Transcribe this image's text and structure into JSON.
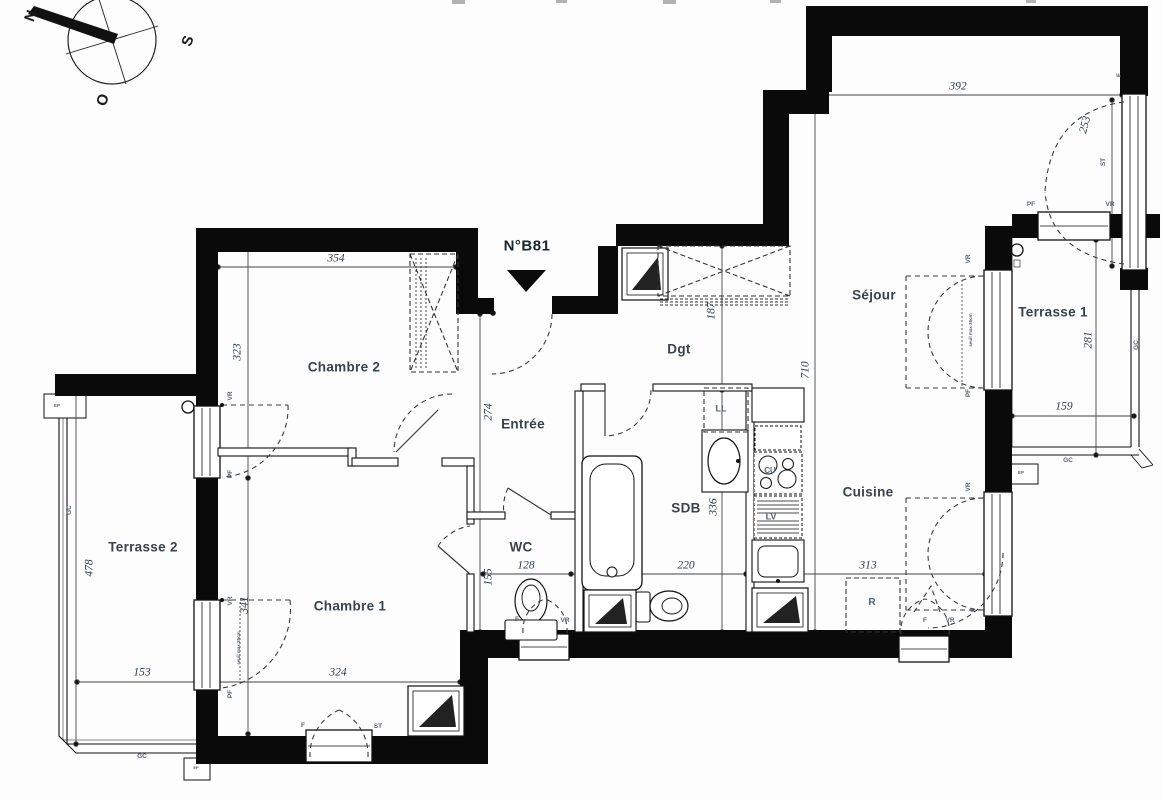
{
  "meta": {
    "plan_number": "N°B81"
  },
  "compass": {
    "points": [
      {
        "letter": "N",
        "x": 31,
        "y": 16,
        "rot": -70
      },
      {
        "letter": "S",
        "x": 188,
        "y": 41,
        "rot": -70
      },
      {
        "letter": "O",
        "x": 103,
        "y": 100,
        "rot": -70
      }
    ]
  },
  "rooms": [
    {
      "id": "chambre-2",
      "name": "Chambre 2",
      "x": 344,
      "y": 367
    },
    {
      "id": "chambre-1",
      "name": "Chambre 1",
      "x": 350,
      "y": 606
    },
    {
      "id": "entree",
      "name": "Entrée",
      "x": 523,
      "y": 424
    },
    {
      "id": "wc",
      "name": "WC",
      "x": 521,
      "y": 547
    },
    {
      "id": "sdb",
      "name": "SDB",
      "x": 686,
      "y": 508
    },
    {
      "id": "dgt",
      "name": "Dgt",
      "x": 679,
      "y": 349
    },
    {
      "id": "sejour",
      "name": "Séjour",
      "x": 874,
      "y": 295
    },
    {
      "id": "cuisine",
      "name": "Cuisine",
      "x": 868,
      "y": 492
    },
    {
      "id": "terrasse-1",
      "name": "Terrasse 1",
      "x": 1053,
      "y": 312
    },
    {
      "id": "terrasse-2",
      "name": "Terrasse 2",
      "x": 143,
      "y": 547
    }
  ],
  "dimensions": [
    {
      "value": "354",
      "x": 336,
      "y": 259,
      "rot": 0
    },
    {
      "value": "323",
      "x": 238,
      "y": 352,
      "rot": -90
    },
    {
      "value": "341",
      "x": 245,
      "y": 605,
      "rot": -90
    },
    {
      "value": "324",
      "x": 338,
      "y": 673,
      "rot": 0
    },
    {
      "value": "274",
      "x": 489,
      "y": 412,
      "rot": -90
    },
    {
      "value": "155",
      "x": 489,
      "y": 577,
      "rot": -90
    },
    {
      "value": "128",
      "x": 526,
      "y": 566,
      "rot": 0
    },
    {
      "value": "220",
      "x": 686,
      "y": 566,
      "rot": 0
    },
    {
      "value": "313",
      "x": 868,
      "y": 566,
      "rot": 0
    },
    {
      "value": "187",
      "x": 712,
      "y": 311,
      "rot": -90
    },
    {
      "value": "336",
      "x": 714,
      "y": 507,
      "rot": -90
    },
    {
      "value": "710",
      "x": 806,
      "y": 370,
      "rot": -90
    },
    {
      "value": "392",
      "x": 958,
      "y": 87,
      "rot": 0
    },
    {
      "value": "253",
      "x": 1086,
      "y": 125,
      "rot": -75
    },
    {
      "value": "281",
      "x": 1089,
      "y": 340,
      "rot": -90
    },
    {
      "value": "159",
      "x": 1064,
      "y": 407,
      "rot": 0
    },
    {
      "value": "478",
      "x": 90,
      "y": 568,
      "rot": -90
    },
    {
      "value": "153",
      "x": 142,
      "y": 673,
      "rot": 0
    }
  ],
  "labels": [
    {
      "text": "VR",
      "x": 231,
      "y": 396,
      "rot": -90
    },
    {
      "text": "PF",
      "x": 231,
      "y": 474,
      "rot": -90
    },
    {
      "text": "VR",
      "x": 231,
      "y": 601,
      "rot": -90
    },
    {
      "text": "PF",
      "x": 231,
      "y": 694,
      "rot": -90
    },
    {
      "text": "seuil max 35cm",
      "x": 239,
      "y": 648,
      "rot": -90,
      "size": 4.5
    },
    {
      "text": "F",
      "x": 517,
      "y": 620,
      "rot": 0
    },
    {
      "text": "VR",
      "x": 565,
      "y": 621,
      "rot": 0
    },
    {
      "text": "F",
      "x": 303,
      "y": 726,
      "rot": 0
    },
    {
      "text": "ST",
      "x": 378,
      "y": 727,
      "rot": 0
    },
    {
      "text": "F",
      "x": 925,
      "y": 621,
      "rot": 0
    },
    {
      "text": "VR",
      "x": 950,
      "y": 621,
      "rot": 0
    },
    {
      "text": "VR",
      "x": 969,
      "y": 259,
      "rot": -90
    },
    {
      "text": "PF",
      "x": 969,
      "y": 393,
      "rot": -90
    },
    {
      "text": "seuil max 35cm",
      "x": 971,
      "y": 330,
      "rot": -90,
      "size": 4.5
    },
    {
      "text": "VR",
      "x": 969,
      "y": 487,
      "rot": -90
    },
    {
      "text": "F",
      "x": 974,
      "y": 610,
      "rot": -90
    },
    {
      "text": "PF",
      "x": 1031,
      "y": 205,
      "rot": 0
    },
    {
      "text": "VR",
      "x": 1110,
      "y": 205,
      "rot": 0
    },
    {
      "text": "F",
      "x": 1120,
      "y": 75,
      "rot": -90
    },
    {
      "text": "ST",
      "x": 1104,
      "y": 162,
      "rot": -90
    },
    {
      "text": "GC",
      "x": 70,
      "y": 510,
      "rot": -90
    },
    {
      "text": "GC",
      "x": 142,
      "y": 757,
      "rot": 0
    },
    {
      "text": "GC",
      "x": 1137,
      "y": 345,
      "rot": -90
    },
    {
      "text": "GC",
      "x": 1068,
      "y": 461,
      "rot": 0
    },
    {
      "text": "EP",
      "x": 57,
      "y": 406,
      "rot": 0,
      "size": 4.5
    },
    {
      "text": "EP",
      "x": 1021,
      "y": 473,
      "rot": 0,
      "size": 4.5
    },
    {
      "text": "EP",
      "x": 196,
      "y": 768,
      "rot": 0,
      "size": 4
    },
    {
      "text": "LL",
      "x": 721,
      "y": 409,
      "rot": 0,
      "size": 9
    },
    {
      "text": "CU",
      "x": 770,
      "y": 471,
      "rot": 0,
      "size": 8
    },
    {
      "text": "LV",
      "x": 771,
      "y": 517,
      "rot": 0,
      "size": 9
    },
    {
      "text": "R",
      "x": 872,
      "y": 603,
      "rot": 0,
      "size": 10
    }
  ]
}
